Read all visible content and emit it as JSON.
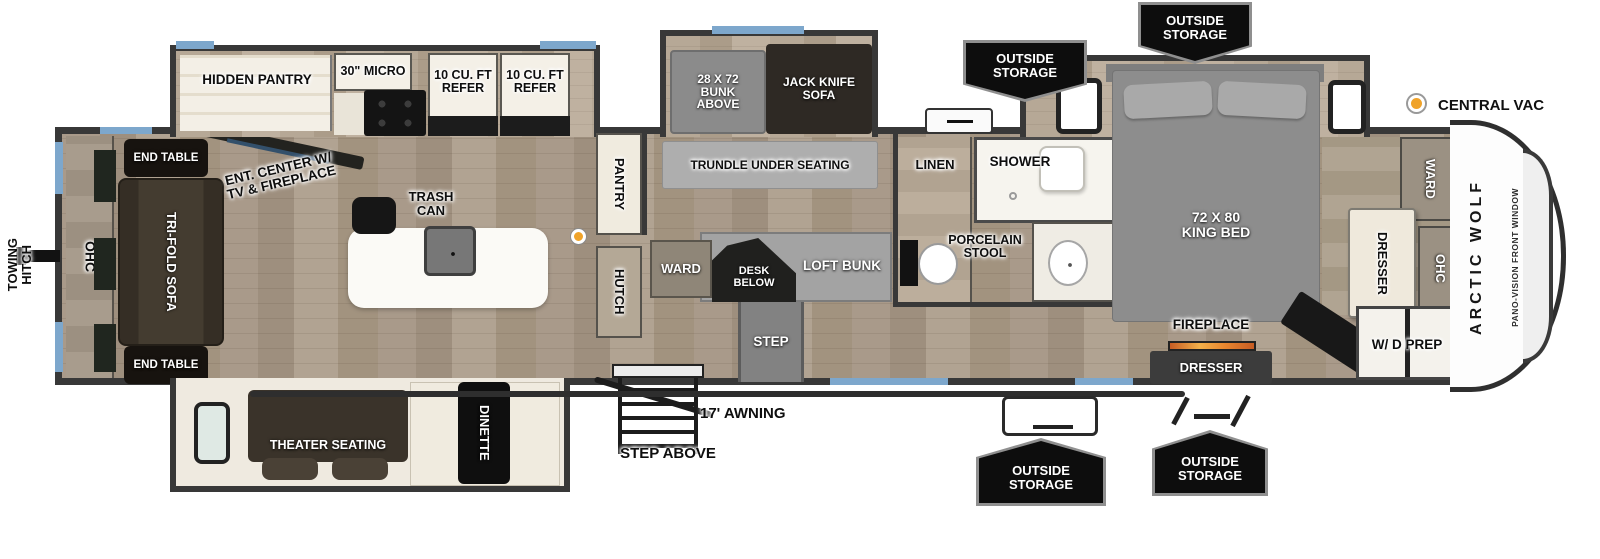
{
  "labels": {
    "towing_hitch_line1": "TOWING",
    "towing_hitch_line2": "HITCH",
    "ohc_left": "OHC",
    "end_table_top": "END TABLE",
    "end_table_bottom": "END TABLE",
    "tri_fold_sofa": "TRI-FOLD SOFA",
    "ent_center": "ENT. CENTER W/ TV & FIREPLACE",
    "hidden_pantry": "HIDDEN PANTRY",
    "micro": "30\" MICRO",
    "refer_1": "10 CU. FT REFER",
    "refer_2": "10 CU. FT REFER",
    "trash_can": "TRASH CAN",
    "bunk_above": "28 X 72 BUNK ABOVE",
    "jack_knife_sofa": "JACK KNIFE SOFA",
    "trundle": "TRUNDLE UNDER SEATING",
    "pantry": "PANTRY",
    "hutch": "HUTCH",
    "ward_bunk": "WARD",
    "desk_below": "DESK BELOW",
    "loft_bunk": "LOFT BUNK",
    "step": "STEP",
    "linen": "LINEN",
    "shower": "SHOWER",
    "porcelain_stool": "PORCELAIN STOOL",
    "king_bed": "72 X 80 KING BED",
    "ward_bedroom": "WARD",
    "dresser_bedroom": "DRESSER",
    "ohc_bedroom": "OHC",
    "fireplace": "FIREPLACE",
    "dresser_front": "DRESSER",
    "wd_prep": "W/ D PREP",
    "theater_seating": "THEATER SEATING",
    "dinette": "DINETTE",
    "awning": "17' AWNING",
    "step_above": "STEP ABOVE",
    "central_vac": "CENTRAL VAC",
    "brand": "ARCTIC WOLF",
    "front_window": "PANO-VISION FRONT WINDOW",
    "outside_storage": [
      "OUTSIDE STORAGE",
      "OUTSIDE STORAGE",
      "OUTSIDE STORAGE",
      "OUTSIDE STORAGE"
    ]
  },
  "colors": {
    "wall": "#383838",
    "window_blue": "#7da7cc",
    "vac_dot_orange": "#f0a32a",
    "fireplace_glow": "#e8862f",
    "badge_black": "#0d0d0d"
  }
}
